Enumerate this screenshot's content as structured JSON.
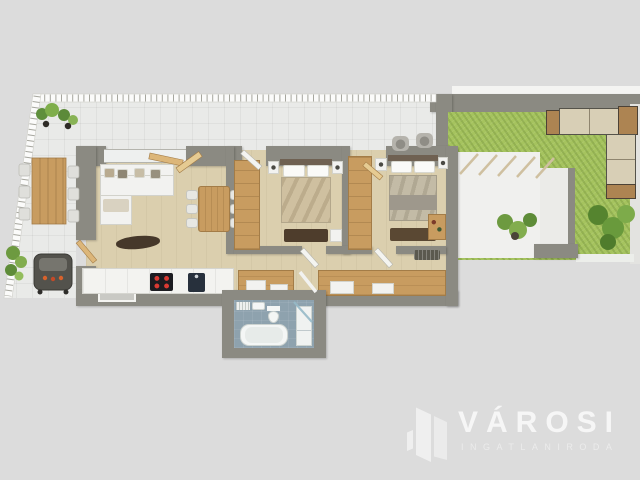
{
  "brand": {
    "name": "VÁROSI",
    "tagline": "INGATLANIRODA",
    "logo_icon": "buildings-icon"
  },
  "colors": {
    "background": "#dcdcdc",
    "wall": "#8b8a82",
    "floor-wood": "#dbcfae",
    "terrace-tile": "#e9eae8",
    "grass": "#a5c35e",
    "furniture-wood": "#c89c60",
    "dark-wood": "#4e3d2c",
    "white-furniture": "#f2f2f0",
    "bath-floor": "#8ea2ae",
    "logo-white": "#ffffff"
  },
  "floorplan": {
    "type": "3d-top-down-apartment-render",
    "rooms": [
      {
        "name": "terrace",
        "furniture": [
          "railing",
          "outdoor-dining-table",
          "outdoor-chairs",
          "bbq-grill",
          "potted-plants",
          "lounge-chairs"
        ]
      },
      {
        "name": "living-dining-room",
        "furniture": [
          "l-shaped-sofa",
          "throw-pillows",
          "coffee-table",
          "dining-table",
          "six-dining-chairs"
        ]
      },
      {
        "name": "kitchen",
        "furniture": [
          "counter",
          "induction-hob",
          "sink",
          "window-recess"
        ]
      },
      {
        "name": "bedroom-1",
        "furniture": [
          "double-bed",
          "two-nightstands",
          "wardrobe",
          "dresser",
          "bench"
        ]
      },
      {
        "name": "bedroom-2",
        "furniture": [
          "double-bed",
          "two-nightstands",
          "wardrobe",
          "desk",
          "radiator",
          "bookshelf"
        ]
      },
      {
        "name": "hallway",
        "furniture": [
          "built-in-closets"
        ]
      },
      {
        "name": "bathroom",
        "furniture": [
          "bathtub",
          "toilet",
          "washbasin",
          "vanity",
          "shower-glass",
          "towel-radiator"
        ]
      },
      {
        "name": "garden",
        "furniture": [
          "lawn",
          "outdoor-corner-sofa",
          "plants",
          "pergola-beams",
          "patio"
        ]
      }
    ]
  }
}
